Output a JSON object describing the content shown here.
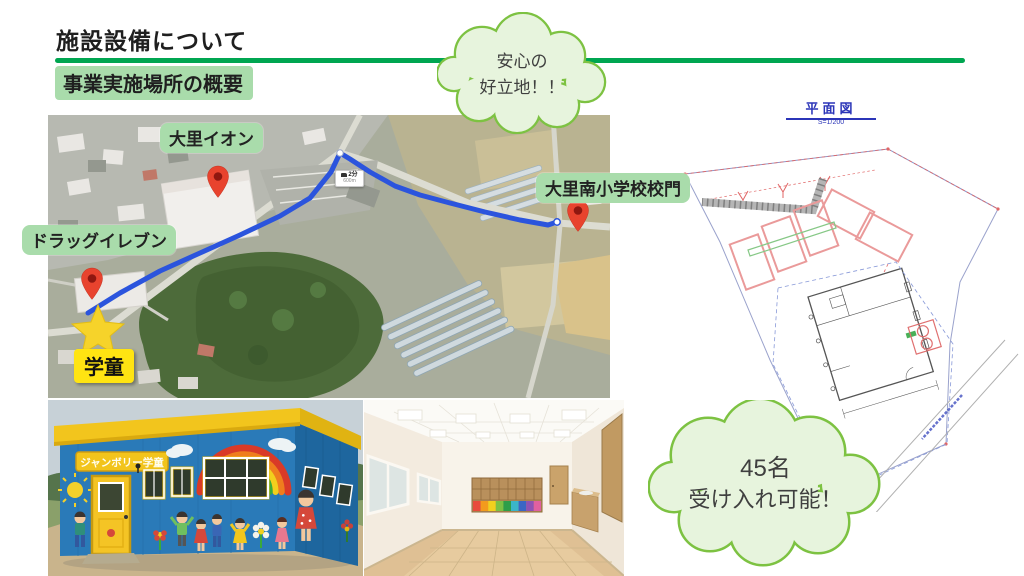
{
  "slide": {
    "title": "施設設備について",
    "subtitle": "事業実施場所の概要"
  },
  "callouts": {
    "location": {
      "line1": "安心の",
      "line2": "好立地！！"
    },
    "capacity": {
      "line1": "45名",
      "line2": "受け入れ可能！"
    }
  },
  "map": {
    "labels": {
      "aeon": "大里イオン",
      "school_gate": "大里南小学校校門",
      "drugstore": "ドラッグイレブン",
      "gakudo": "学童"
    },
    "route": {
      "duration": "2分",
      "distance": "600m"
    }
  },
  "floorplan": {
    "title": "平面図",
    "scale": "S=1/200"
  },
  "building": {
    "sign": "ジャンボリー学童"
  },
  "colors": {
    "accent_green": "#00a651",
    "label_green": "#a9dcab",
    "cloud_border": "#7dc242",
    "cloud_fill": "#e7f4dd",
    "route_blue": "#2b54dd",
    "pin_red": "#e8432e",
    "highlight_yellow": "#ffe412",
    "plan_blue": "#2b35b8"
  }
}
